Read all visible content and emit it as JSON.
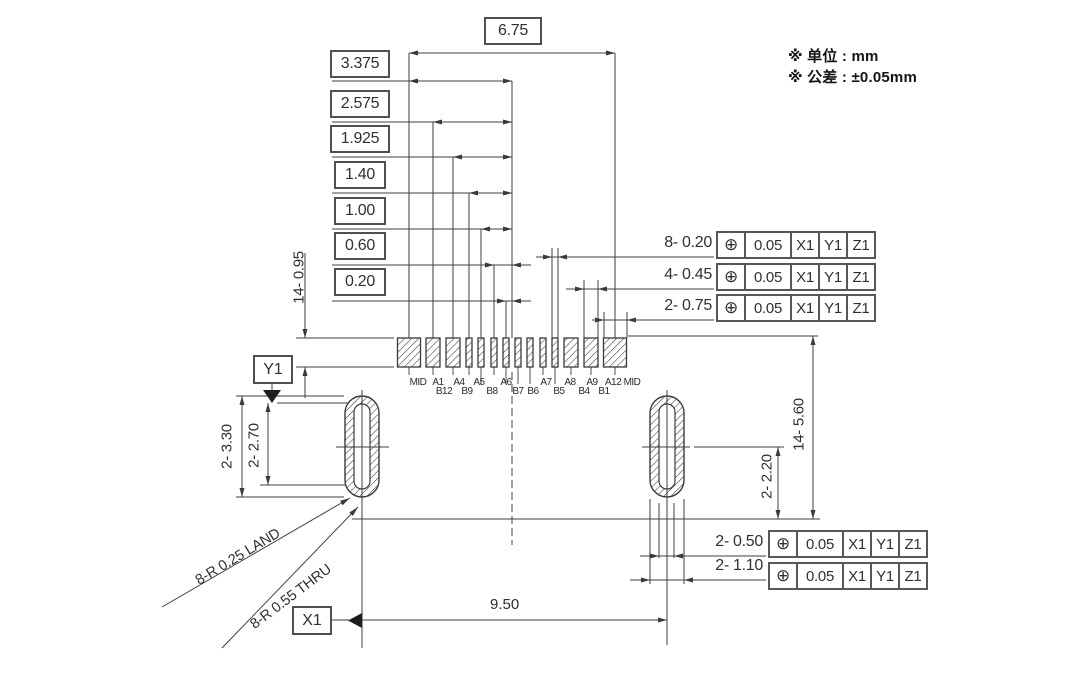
{
  "notes": {
    "unit": "※ 单位 : mm",
    "tolerance": "※ 公差 : ±0.05mm"
  },
  "dims": {
    "span": "6.75",
    "half_span": "3.375",
    "row3": "2.575",
    "row4": "1.925",
    "row5": "1.40",
    "row6": "1.00",
    "row7": "0.60",
    "row8": "0.20",
    "pad_height": "14- 0.95",
    "slot_outer_height": "2- 3.30",
    "slot_inner_height": "2- 2.70",
    "pad_to_ref": "14- 5.60",
    "slot_to_ref": "2- 2.20",
    "slot_pitch": "9.50",
    "land_radius": "8-R 0.25 LAND",
    "thru_radius": "8-R 0.55 THRU"
  },
  "datums": {
    "x1": "X1",
    "y1": "Y1"
  },
  "fcf_top": [
    {
      "label": "8- 0.20",
      "sym": "⊕",
      "tol": "0.05",
      "refs": [
        "X1",
        "Y1",
        "Z1"
      ]
    },
    {
      "label": "4- 0.45",
      "sym": "⊕",
      "tol": "0.05",
      "refs": [
        "X1",
        "Y1",
        "Z1"
      ]
    },
    {
      "label": "2- 0.75",
      "sym": "⊕",
      "tol": "0.05",
      "refs": [
        "X1",
        "Y1",
        "Z1"
      ]
    }
  ],
  "fcf_bottom": [
    {
      "label": "2- 0.50",
      "sym": "⊕",
      "tol": "0.05",
      "refs": [
        "X1",
        "Y1",
        "Z1"
      ]
    },
    {
      "label": "2- 1.10",
      "sym": "⊕",
      "tol": "0.05",
      "refs": [
        "X1",
        "Y1",
        "Z1"
      ]
    }
  ],
  "pads": {
    "top": [
      "MID",
      "A1",
      "A4",
      "A5",
      "A6",
      "A7",
      "A8",
      "A9",
      "A12",
      "MID"
    ],
    "bottom": [
      "B12",
      "B9",
      "B8",
      "B7",
      "B6",
      "B5",
      "B4",
      "B1"
    ]
  }
}
